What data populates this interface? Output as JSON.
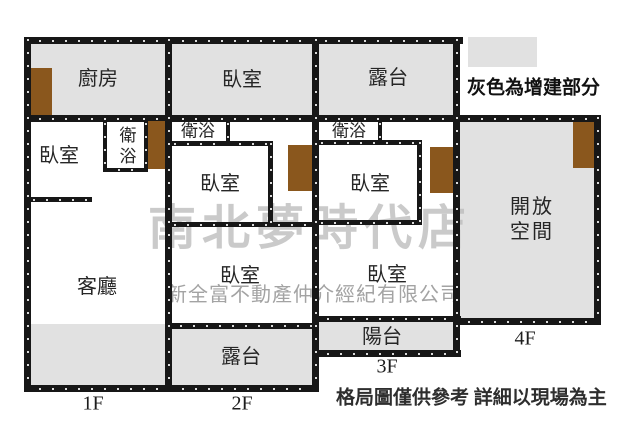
{
  "legend": {
    "label": "灰色為增建部分"
  },
  "disclaimer": "格局圖僅供參考 詳細以現場為主",
  "watermarks": {
    "store": "南北夢時代店",
    "company": "新全富不動產仲介經紀有限公司"
  },
  "rooms": {
    "f1_kitchen": "廚房",
    "f1_bedroom": "臥室",
    "f1_bath": "衛浴",
    "f1_living": "客廳",
    "f2_bedroom_top": "臥室",
    "f2_bath": "衛浴",
    "f2_bedroom_mid": "臥室",
    "f2_bedroom_low": "臥室",
    "f2_terrace": "露台",
    "f3_terrace": "露台",
    "f3_bath": "衛浴",
    "f3_bedroom_mid": "臥室",
    "f3_bedroom_low": "臥室",
    "f3_balcony": "陽台",
    "f4_open_space": "開放空間"
  },
  "floor_labels": {
    "f1": "1F",
    "f2": "2F",
    "f3": "3F",
    "f4": "4F"
  },
  "colors": {
    "extension_gray": "#e1e1e1",
    "door_brown": "#8a571d",
    "wall_black": "#171717",
    "watermark_gray": "#bdbdbd",
    "company_watermark_gray": "#9a9a9a"
  }
}
